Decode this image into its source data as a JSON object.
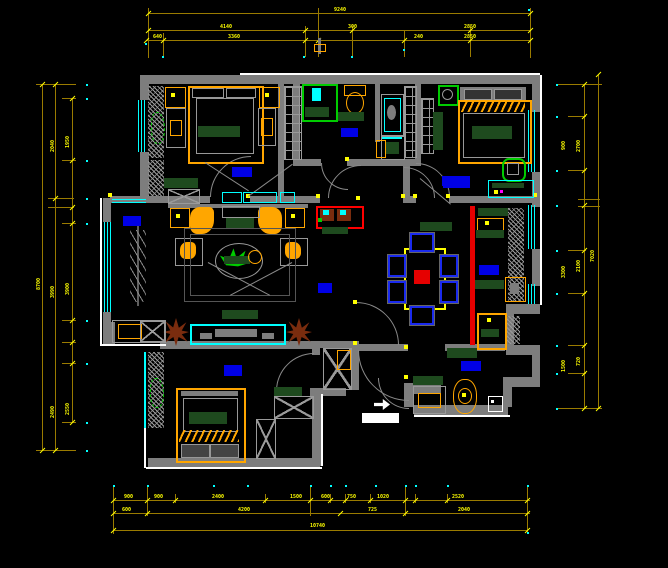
{
  "app": {
    "type": "cad-floor-plan",
    "background": "#000000"
  },
  "colors": {
    "background": "#000000",
    "wall": "#7d7d7d",
    "wall_dark": "#5f5f5f",
    "outline_white": "#ffffff",
    "window_cyan": "#00ffff",
    "dim_line": "#9a7b00",
    "dim_text": "#ffff00",
    "osnap_cyan": "#00ffff",
    "furniture_orange": "#ffa600",
    "cushion_green": "#1e4a1e",
    "plant_green": "#00cc00",
    "plant_brown": "#7a2c0e",
    "rug_blue": "#0000e6",
    "chair_blue": "#1a2aee",
    "accent_red": "#e60000"
  },
  "dims": {
    "top": [
      {
        "t": "9240",
        "x": 334,
        "y": 8
      },
      {
        "t": "4140",
        "x": 220,
        "y": 25
      },
      {
        "t": "300",
        "x": 348,
        "y": 25
      },
      {
        "t": "2850",
        "x": 464,
        "y": 25
      },
      {
        "t": "640",
        "x": 153,
        "y": 35
      },
      {
        "t": "3360",
        "x": 228,
        "y": 35
      },
      {
        "t": "240",
        "x": 414,
        "y": 35
      },
      {
        "t": "2850",
        "x": 464,
        "y": 35
      }
    ],
    "bottom": [
      {
        "t": "900",
        "x": 124,
        "y": 495
      },
      {
        "t": "900",
        "x": 154,
        "y": 495
      },
      {
        "t": "2400",
        "x": 212,
        "y": 495
      },
      {
        "t": "1500",
        "x": 290,
        "y": 495
      },
      {
        "t": "600",
        "x": 321,
        "y": 495
      },
      {
        "t": "750",
        "x": 347,
        "y": 495
      },
      {
        "t": "1020",
        "x": 377,
        "y": 495
      },
      {
        "t": "2520",
        "x": 452,
        "y": 495
      },
      {
        "t": "600",
        "x": 122,
        "y": 508
      },
      {
        "t": "4200",
        "x": 238,
        "y": 508
      },
      {
        "t": "725",
        "x": 368,
        "y": 508
      },
      {
        "t": "2040",
        "x": 458,
        "y": 508
      },
      {
        "t": "10740",
        "x": 310,
        "y": 524
      }
    ],
    "left": [
      {
        "t": "1950",
        "x": 66,
        "y": 148,
        "rot": true
      },
      {
        "t": "3900",
        "x": 66,
        "y": 295,
        "rot": true
      },
      {
        "t": "2550",
        "x": 66,
        "y": 415,
        "rot": true
      },
      {
        "t": "2040",
        "x": 51,
        "y": 152,
        "rot": true
      },
      {
        "t": "3990",
        "x": 51,
        "y": 298,
        "rot": true
      },
      {
        "t": "2490",
        "x": 51,
        "y": 418,
        "rot": true
      },
      {
        "t": "8700",
        "x": 37,
        "y": 290,
        "rot": true
      }
    ],
    "right": [
      {
        "t": "900",
        "x": 562,
        "y": 150,
        "rot": true
      },
      {
        "t": "2700",
        "x": 577,
        "y": 152,
        "rot": true
      },
      {
        "t": "3300",
        "x": 562,
        "y": 278,
        "rot": true
      },
      {
        "t": "2100",
        "x": 577,
        "y": 272,
        "rot": true
      },
      {
        "t": "1500",
        "x": 562,
        "y": 372,
        "rot": true
      },
      {
        "t": "720",
        "x": 577,
        "y": 366,
        "rot": true
      },
      {
        "t": "7020",
        "x": 591,
        "y": 262,
        "rot": true
      }
    ]
  },
  "icons": [
    "double-bed-icon",
    "single-bed-icon",
    "sofa-set-icon",
    "coffee-table-icon",
    "tv-stand-icon",
    "dining-table-icon",
    "chair-icon",
    "toilet-icon",
    "shower-icon",
    "washbasin-icon",
    "washing-machine-icon",
    "wardrobe-icon",
    "fridge-icon",
    "stove-icon",
    "sink-icon",
    "plant-icon",
    "tree-icon",
    "ceiling-fan-icon",
    "door-arc-icon",
    "window-icon",
    "rug-icon",
    "entry-arrow-icon"
  ]
}
